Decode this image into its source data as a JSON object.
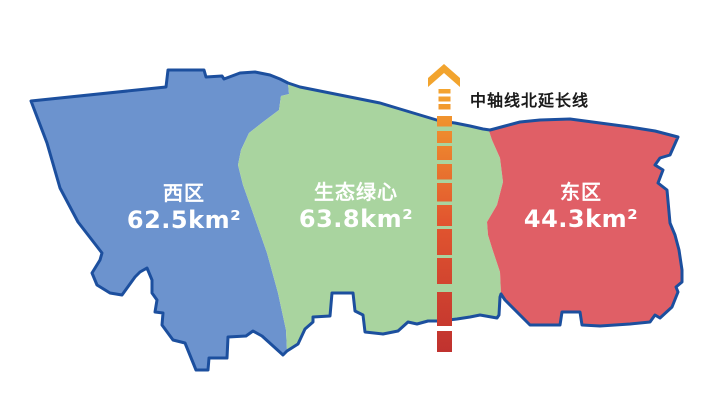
{
  "map": {
    "background": "#FFFFFF",
    "border_color": "#1C4F9E",
    "label_text_color": "#FFFFFF",
    "axis_label_color": "#1A1A1A"
  },
  "regions": [
    {
      "id": "west",
      "name": "西区",
      "area": "62.5km²",
      "fill": "#6C93CE"
    },
    {
      "id": "green-heart",
      "name": "生态绿心",
      "area": "63.8km²",
      "fill": "#A9D49F"
    },
    {
      "id": "east",
      "name": "东区",
      "area": "44.3km²",
      "fill": "#E05F66"
    }
  ],
  "axis": {
    "label": "中轴线北延长线",
    "arrow_color": "#F2A42E",
    "gradient_start": "#F4A42E",
    "gradient_mid": "#E2562F",
    "gradient_end": "#C0322F"
  }
}
